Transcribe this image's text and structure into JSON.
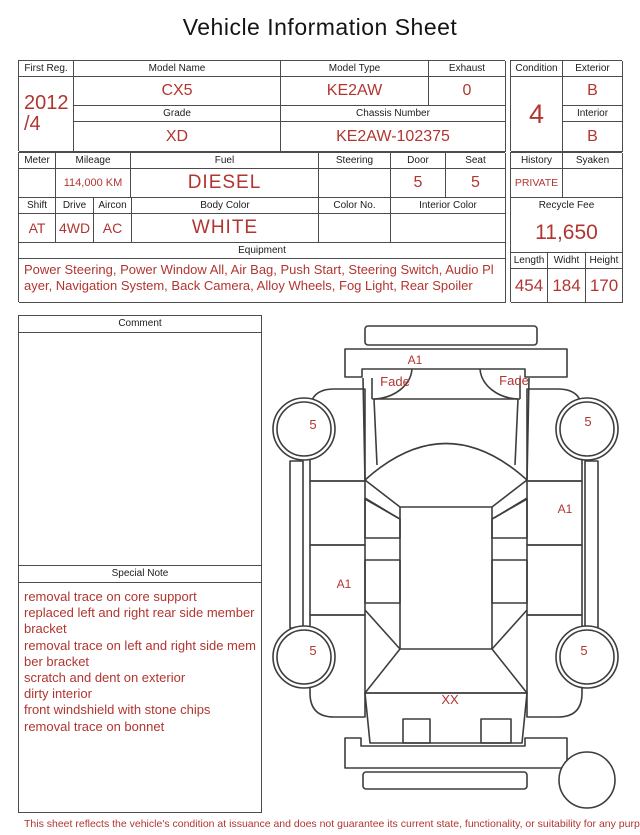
{
  "title": "Vehicle Information Sheet",
  "colors": {
    "accent_red": "#b23530",
    "line_gray": "#4c4c4c"
  },
  "header_row1": {
    "first_reg_label": "First Reg.",
    "first_reg_value_l1": "2012",
    "first_reg_value_l2": "/4",
    "model_name_label": "Model Name",
    "model_name_value": "CX5",
    "model_type_label": "Model Type",
    "model_type_value": "KE2AW",
    "exhaust_label": "Exhaust",
    "exhaust_value": "0",
    "grade_label": "Grade",
    "grade_value": "XD",
    "chassis_label": "Chassis Number",
    "chassis_value": "KE2AW-102375",
    "condition_label": "Condition",
    "condition_value": "4",
    "exterior_label": "Exterior",
    "exterior_value": "B",
    "interior_label": "Interior",
    "interior_value": "B"
  },
  "header_row2": {
    "meter_label": "Meter",
    "meter_value": "",
    "mileage_label": "Mileage",
    "mileage_value": "114,000 KM",
    "fuel_label": "Fuel",
    "fuel_value": "DIESEL",
    "steering_label": "Steering",
    "steering_value": "",
    "door_label": "Door",
    "door_value": "5",
    "seat_label": "Seat",
    "seat_value": "5",
    "history_label": "History",
    "history_value": "PRIVATE",
    "syaken_label": "Syaken",
    "syaken_value": "",
    "shift_label": "Shift",
    "shift_value": "AT",
    "drive_label": "Drive",
    "drive_value": "4WD",
    "aircon_label": "Aircon",
    "aircon_value": "AC",
    "body_color_label": "Body Color",
    "body_color_value": "WHITE",
    "color_no_label": "Color No.",
    "color_no_value": "",
    "interior_color_label": "Interior Color",
    "interior_color_value": "",
    "recycle_fee_label": "Recycle Fee",
    "recycle_fee_value": "11,650",
    "length_label": "Length",
    "length_value": "454",
    "width_label": "Widht",
    "width_value": "184",
    "height_label": "Height",
    "height_value": "170"
  },
  "equipment": {
    "label": "Equipment",
    "value": "Power Steering, Power Window  All, Air Bag, Push Start, Steering Switch, Audio Player, Navigation System, Back Camera, Alloy Wheels, Fog Light, Rear Spoiler"
  },
  "comment": {
    "label": "Comment",
    "value": ""
  },
  "special_note": {
    "label": "Special Note",
    "notes": [
      "removal trace on core support",
      "replaced left and right rear side member bracket",
      "removal trace on left and right side member bracket",
      "scratch and dent on exterior",
      "dirty interior",
      "front windshield with stone chips",
      "removal trace on bonnet"
    ]
  },
  "diagram": {
    "front_bumper_label": "A1",
    "headlight_left_label": "Fade",
    "headlight_right_label": "Fade",
    "wheel_front_left_label": "5",
    "wheel_front_right_label": "5",
    "door_right_front_label": "A1",
    "door_left_rear_label": "A1",
    "wheel_rear_left_label": "5",
    "wheel_rear_right_label": "5",
    "rear_gate_label": "XX"
  },
  "footer": "This sheet reflects the vehicle's condition at issuance and does not guarantee its current state, functionality, or suitability for any purpose"
}
